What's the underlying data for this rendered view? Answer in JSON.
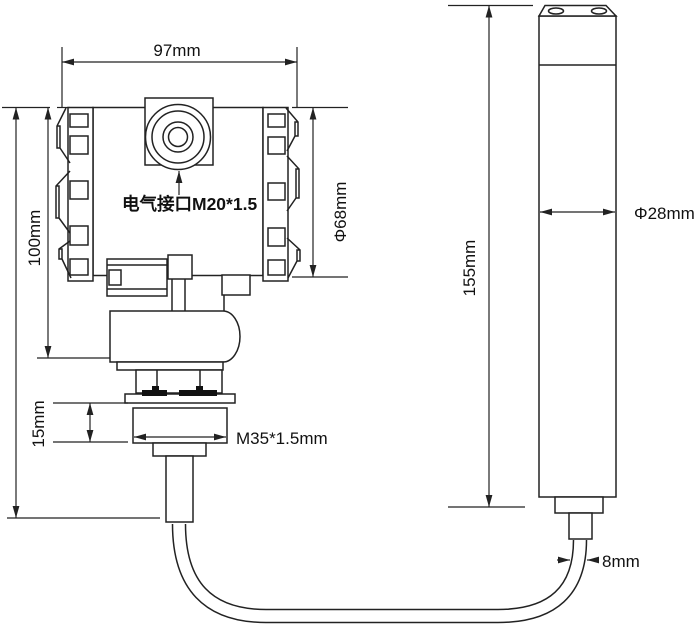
{
  "colors": {
    "ink": "#222222",
    "background": "#ffffff",
    "bolt_fill": "#111111"
  },
  "transmitter": {
    "width_label": "97mm",
    "height_label": "100mm",
    "diameter_label": "Φ68mm",
    "electrical_port_label": "电气接口M20*1.5",
    "neck_height_label": "15mm",
    "thread_label": "M35*1.5mm"
  },
  "probe": {
    "length_label": "155mm",
    "diameter_label": "Φ28mm",
    "cable_label": "8mm"
  }
}
